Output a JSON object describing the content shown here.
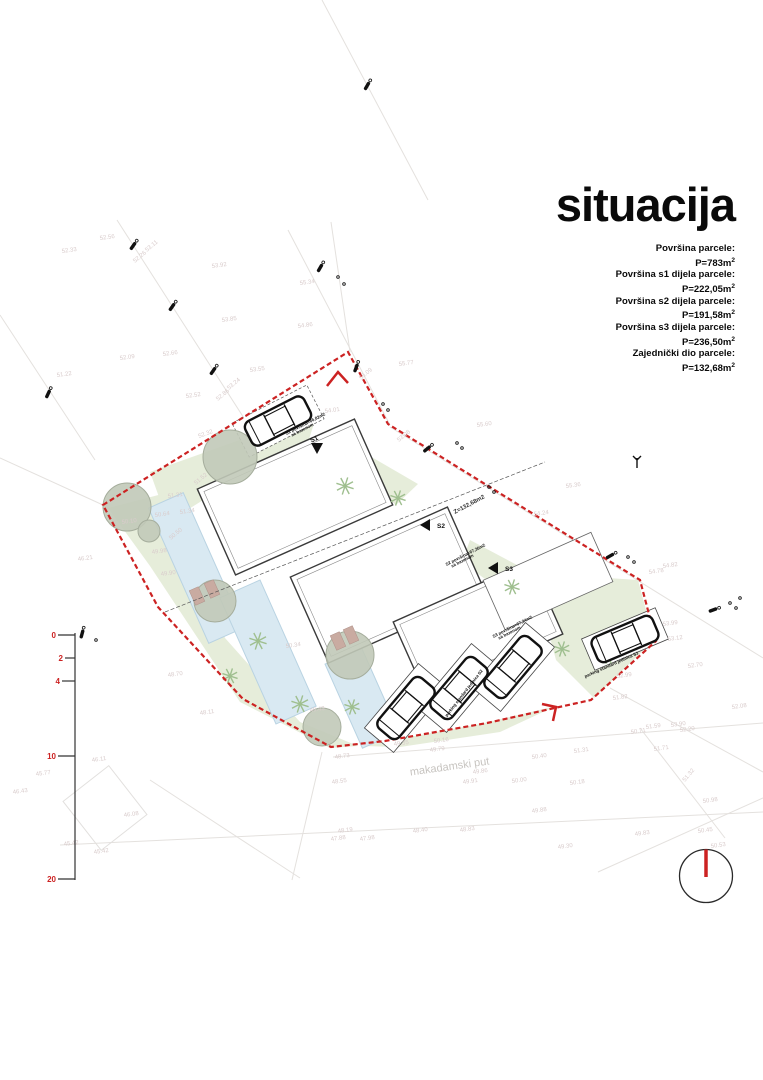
{
  "title": "situacija",
  "areas": {
    "lines": [
      {
        "label": "Površina parcele:",
        "value": "P=783m",
        "sup": "2"
      },
      {
        "label": "Površina s1 dijela parcele:",
        "value": "P=222,05m",
        "sup": "2"
      },
      {
        "label": "Površina s2 dijela parcele:",
        "value": "P=191,58m",
        "sup": "2"
      },
      {
        "label": "Površina s3 dijela parcele:",
        "value": "P=236,50m",
        "sup": "2"
      },
      {
        "label": "Zajednički dio parcele:",
        "value": "P=132,68m",
        "sup": "2"
      }
    ]
  },
  "colors": {
    "boundary": "#cc2222",
    "scale_red": "#cc2222",
    "green": "#e6edda",
    "pool_fill": "#d9e9f2",
    "pool_stroke": "#b9d3e2",
    "tree_fill": "#c1c9b8",
    "tree_stroke": "#a5ad9c",
    "palm": "#9fbf8f",
    "lounger": "#c9aba1",
    "elevation": "#d9cccc",
    "road": "#e4e1de",
    "building_stroke": "#3a3a3a"
  },
  "scale": {
    "marks": [
      "0",
      "2",
      "4",
      "10",
      "20"
    ],
    "ys": [
      635,
      658,
      681,
      756,
      879
    ],
    "ticks": [
      17,
      10,
      13,
      17,
      17
    ],
    "bar_x": 75
  },
  "plan": {
    "boundary": "103,505 348,352 388,424 640,580 656,641 591,700 487,723 385,741 331,747 243,699 158,607",
    "chevrons": [
      "327,386 338,372 348,383",
      "542,704 556,707 553,721"
    ],
    "roads": [
      [
        117,
        220,
        258,
        440
      ],
      [
        0,
        315,
        95,
        460
      ],
      [
        288,
        230,
        390,
        425
      ],
      [
        390,
        427,
        763,
        658
      ],
      [
        331,
        222,
        350,
        352
      ],
      [
        322,
        0,
        428,
        200
      ],
      [
        0,
        458,
        103,
        505
      ],
      [
        333,
        757,
        763,
        723
      ],
      [
        60,
        845,
        763,
        812
      ],
      [
        322,
        752,
        292,
        880
      ],
      [
        598,
        872,
        763,
        798
      ],
      [
        610,
        688,
        763,
        772
      ],
      [
        640,
        728,
        725,
        838
      ],
      [
        150,
        780,
        300,
        878
      ]
    ],
    "greens": [
      "150,472 262,432 315,420 302,462 232,482 168,522",
      "108,508 170,492 225,638 300,722 358,746 330,748 240,702 150,566",
      "360,746 480,724 556,706 500,732 400,747",
      "548,574 638,580 654,640 594,698 556,660 540,600",
      "356,448 418,484 396,505 352,470",
      "470,540 530,572 508,596 462,562"
    ],
    "pools": [
      [
        196,
        568,
        38,
        148,
        -24
      ],
      [
        268,
        652,
        44,
        138,
        -24
      ],
      [
        362,
        698,
        40,
        92,
        -24
      ]
    ],
    "buildings_main": [
      [
        295,
        497,
        172,
        94,
        -24
      ],
      [
        388,
        585,
        172,
        94,
        -24
      ],
      [
        478,
        628,
        150,
        80,
        -24
      ]
    ],
    "buildings_thin": [
      [
        548,
        581,
        118,
        54,
        -24
      ]
    ],
    "dash_lines": [
      [
        165,
        612,
        545,
        462
      ]
    ],
    "trees": [
      [
        230,
        457,
        27
      ],
      [
        127,
        507,
        24
      ],
      [
        215,
        601,
        21
      ],
      [
        350,
        655,
        24
      ],
      [
        322,
        727,
        19
      ],
      [
        149,
        531,
        11
      ]
    ],
    "palms": [
      [
        345,
        486,
        9
      ],
      [
        398,
        498,
        8
      ],
      [
        258,
        641,
        9
      ],
      [
        300,
        704,
        9
      ],
      [
        352,
        707,
        8
      ],
      [
        396,
        729,
        7
      ],
      [
        512,
        587,
        8
      ],
      [
        562,
        649,
        8
      ],
      [
        230,
        676,
        8
      ],
      [
        608,
        657,
        7
      ]
    ],
    "loungers": [
      [
        197,
        596
      ],
      [
        212,
        589
      ],
      [
        338,
        641
      ],
      [
        351,
        635
      ]
    ],
    "cars": [
      [
        278,
        421,
        -27
      ],
      [
        406,
        708,
        -50
      ],
      [
        459,
        688,
        -50
      ],
      [
        513,
        667,
        -50
      ],
      [
        625,
        639,
        -23
      ]
    ],
    "bays": [
      [
        406,
        708,
        84,
        38,
        -50
      ],
      [
        459,
        688,
        84,
        38,
        -50
      ],
      [
        513,
        667,
        84,
        38,
        -50
      ],
      [
        625,
        639,
        80,
        34,
        -23
      ]
    ],
    "bays_dashed": [
      [
        278,
        421,
        84,
        38,
        -27
      ]
    ],
    "poles": [
      [
        133,
        246,
        -55
      ],
      [
        172,
        307,
        -55
      ],
      [
        213,
        371,
        -55
      ],
      [
        320,
        268,
        -60
      ],
      [
        367,
        86,
        -60
      ],
      [
        48,
        394,
        -65
      ],
      [
        356,
        368,
        -70
      ],
      [
        427,
        449,
        -40
      ],
      [
        610,
        556,
        -30
      ],
      [
        713,
        610,
        -20
      ],
      [
        82,
        634,
        -75
      ]
    ],
    "dots": [
      [
        338,
        277
      ],
      [
        344,
        284
      ],
      [
        383,
        404
      ],
      [
        388,
        410
      ],
      [
        489,
        487
      ],
      [
        494,
        492
      ],
      [
        628,
        557
      ],
      [
        634,
        562
      ],
      [
        730,
        603
      ],
      [
        736,
        608
      ],
      [
        740,
        598
      ],
      [
        96,
        640
      ],
      [
        457,
        443
      ],
      [
        462,
        448
      ]
    ],
    "trident": [
      637,
      462
    ],
    "neighbor_rect": [
      105,
      808,
      58,
      62,
      -38
    ],
    "north": {
      "cx": 706,
      "cy": 876,
      "r": 26.5
    },
    "markers": [
      {
        "pts": "311,443 323,443 317,454"
      },
      {
        "pts": "430,519 430,531 420,525"
      },
      {
        "pts": "498,562 498,574 488,568"
      }
    ],
    "labels": [
      {
        "t": "makadamski put",
        "x": 450,
        "y": 770,
        "r": -8,
        "s": 11,
        "c": "#c7c4c0",
        "w": 400,
        "a": "middle"
      },
      {
        "t": "Z=132,68m2",
        "x": 470,
        "y": 506,
        "r": -28,
        "s": 6,
        "c": "#333333",
        "w": 700,
        "a": "middle"
      },
      {
        "t": "S1 površina=66,82m2",
        "x": 306,
        "y": 425,
        "r": -27,
        "s": 4.3,
        "c": "#111111",
        "w": 700,
        "a": "middle"
      },
      {
        "t": "sa bazenom",
        "x": 303,
        "y": 431,
        "r": -27,
        "s": 4.3,
        "c": "#111111",
        "w": 700,
        "a": "middle"
      },
      {
        "t": "S1",
        "x": 315,
        "y": 441,
        "r": -27,
        "s": 6.5,
        "c": "#111111",
        "w": 700,
        "a": "middle"
      },
      {
        "t": "S2",
        "x": 437,
        "y": 528,
        "r": 0,
        "s": 6.5,
        "c": "#111111",
        "w": 700,
        "a": "start"
      },
      {
        "t": "S3",
        "x": 505,
        "y": 571,
        "r": 0,
        "s": 6.5,
        "c": "#111111",
        "w": 700,
        "a": "start"
      },
      {
        "t": "S2 površina=67,36m2",
        "x": 466,
        "y": 556,
        "r": -27,
        "s": 4.3,
        "c": "#111111",
        "w": 700,
        "a": "middle"
      },
      {
        "t": "sa bazenom",
        "x": 463,
        "y": 562,
        "r": -27,
        "s": 4.3,
        "c": "#111111",
        "w": 700,
        "a": "middle"
      },
      {
        "t": "S3 površina=67,34m2",
        "x": 513,
        "y": 628,
        "r": -27,
        "s": 4.3,
        "c": "#111111",
        "w": 700,
        "a": "middle"
      },
      {
        "t": "sa bazenom",
        "x": 510,
        "y": 634,
        "r": -27,
        "s": 4.3,
        "c": "#111111",
        "w": 700,
        "a": "middle"
      },
      {
        "t": "parking standard jedinica S2",
        "x": 465,
        "y": 694,
        "r": -52,
        "s": 4.3,
        "c": "#111111",
        "w": 700,
        "a": "middle"
      },
      {
        "t": "parking standard jedinica S3",
        "x": 612,
        "y": 666,
        "r": -24,
        "s": 4.3,
        "c": "#111111",
        "w": 700,
        "a": "middle"
      }
    ],
    "elevations": [
      [
        "52.33",
        62,
        253
      ],
      [
        "52.56",
        100,
        240
      ],
      [
        "53.11",
        147,
        252,
        -40
      ],
      [
        "52.26",
        135,
        263,
        -40
      ],
      [
        "53.92",
        212,
        268
      ],
      [
        "55.34",
        300,
        285
      ],
      [
        "53.85",
        222,
        322
      ],
      [
        "54.86",
        298,
        328
      ],
      [
        "52.09",
        120,
        360
      ],
      [
        "52.66",
        163,
        356
      ],
      [
        "53.55",
        250,
        372
      ],
      [
        "51.22",
        57,
        377
      ],
      [
        "52.52",
        186,
        398
      ],
      [
        "53.24",
        229,
        390,
        -40
      ],
      [
        "52.86",
        218,
        401,
        -40
      ],
      [
        "54.01",
        325,
        413
      ],
      [
        "55.09",
        361,
        380,
        -40
      ],
      [
        "55.77",
        399,
        366
      ],
      [
        "55.60",
        477,
        427
      ],
      [
        "55.36",
        566,
        488
      ],
      [
        "54.82",
        663,
        568
      ],
      [
        "54.78",
        649,
        574
      ],
      [
        "53.99",
        663,
        626
      ],
      [
        "53.12",
        668,
        641
      ],
      [
        "52.70",
        688,
        668
      ],
      [
        "52.99",
        617,
        678
      ],
      [
        "51.52",
        196,
        485,
        -40
      ],
      [
        "51.31",
        168,
        498
      ],
      [
        "51.34",
        180,
        514
      ],
      [
        "50.64",
        155,
        517
      ],
      [
        "50.10",
        122,
        524
      ],
      [
        "49.98",
        152,
        554
      ],
      [
        "50.50",
        171,
        540,
        -40
      ],
      [
        "46.21",
        78,
        561
      ],
      [
        "49.90",
        161,
        576
      ],
      [
        "48.70",
        168,
        677
      ],
      [
        "48.11",
        200,
        715
      ],
      [
        "50.34",
        286,
        648
      ],
      [
        "49.43",
        310,
        712
      ],
      [
        "48.73",
        335,
        759
      ],
      [
        "48.55",
        332,
        784
      ],
      [
        "49.35",
        394,
        746
      ],
      [
        "49.79",
        430,
        752
      ],
      [
        "50.16",
        434,
        743
      ],
      [
        "49.86",
        473,
        774
      ],
      [
        "49.91",
        463,
        784
      ],
      [
        "50.00",
        512,
        783
      ],
      [
        "50.40",
        532,
        759
      ],
      [
        "51.31",
        574,
        753
      ],
      [
        "50.18",
        570,
        785
      ],
      [
        "49.88",
        532,
        813
      ],
      [
        "48.40",
        413,
        833
      ],
      [
        "48.83",
        460,
        832
      ],
      [
        "48.19",
        338,
        833
      ],
      [
        "47.88",
        331,
        841
      ],
      [
        "47.98",
        360,
        841
      ],
      [
        "49.30",
        558,
        849
      ],
      [
        "46.11",
        92,
        762
      ],
      [
        "45.77",
        36,
        776
      ],
      [
        "46.43",
        13,
        794
      ],
      [
        "46.08",
        124,
        817
      ],
      [
        "45.42",
        94,
        854
      ],
      [
        "45.42",
        64,
        846
      ],
      [
        "51.82",
        613,
        700
      ],
      [
        "52.08",
        732,
        709
      ],
      [
        "51.59",
        646,
        729
      ],
      [
        "50.71",
        631,
        734
      ],
      [
        "52.20",
        680,
        732
      ],
      [
        "51.71",
        654,
        751
      ],
      [
        "51.32",
        685,
        782,
        -50
      ],
      [
        "50.98",
        703,
        803
      ],
      [
        "49.83",
        635,
        836
      ],
      [
        "50.45",
        698,
        833
      ],
      [
        "50.53",
        711,
        848
      ],
      [
        "53.90",
        671,
        727
      ],
      [
        "54.24",
        534,
        516
      ],
      [
        "53.08",
        399,
        442,
        -40
      ],
      [
        "52.32",
        199,
        438,
        -20
      ]
    ]
  }
}
